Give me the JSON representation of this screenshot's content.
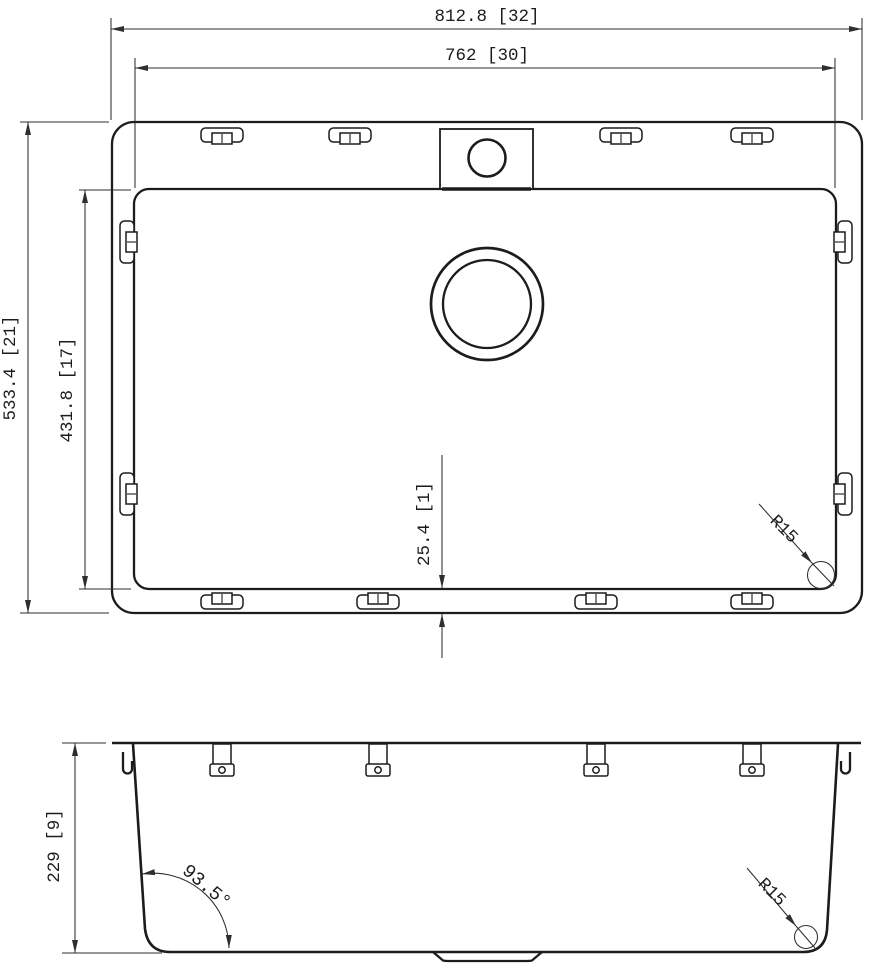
{
  "document": {
    "type": "technical-drawing",
    "background": "#ffffff",
    "line_color": "#1c1c1c"
  },
  "top_view": {
    "dimensions": {
      "overall_width": "812.8 [32]",
      "bowl_width": "762 [30]",
      "overall_depth": "533.4 [21]",
      "bowl_depth": "431.8 [17]",
      "rim_offset": "25.4 [1]",
      "corner_radius": "R15"
    }
  },
  "side_view": {
    "dimensions": {
      "height": "229 [9]",
      "wall_angle": "93.5°",
      "corner_radius": "R15"
    }
  }
}
